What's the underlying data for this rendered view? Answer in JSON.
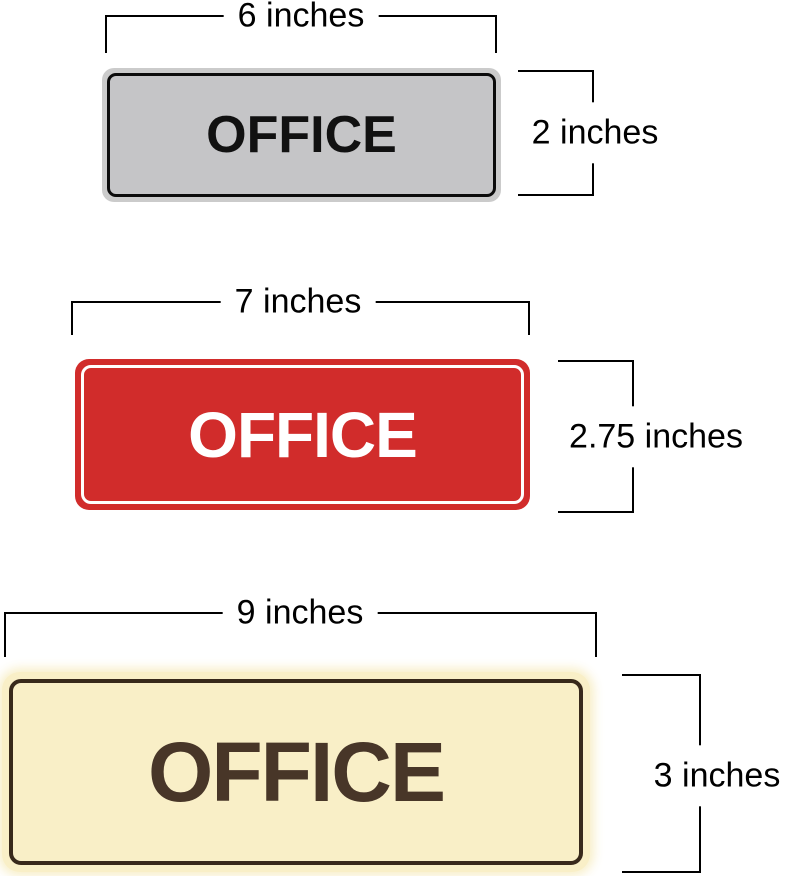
{
  "signs": [
    {
      "label": "OFFICE",
      "width_label": "6 inches",
      "height_label": "2 inches",
      "rim_color": "#cbcbcb",
      "face_color": "#c5c5c7",
      "border_color": "#0b0b0b",
      "text_color": "#111111"
    },
    {
      "label": "OFFICE",
      "width_label": "7 inches",
      "height_label": "2.75 inches",
      "rim_color": "#d12c2b",
      "face_color": "#d12c2b",
      "border_color": "#ffffff",
      "text_color": "#ffffff"
    },
    {
      "label": "OFFICE",
      "width_label": "9 inches",
      "height_label": "3 inches",
      "rim_color": "#f9efc7",
      "face_color": "#f9efc7",
      "border_color": "#38291b",
      "text_color": "#483628"
    }
  ],
  "dimension_line_color": "#000000"
}
